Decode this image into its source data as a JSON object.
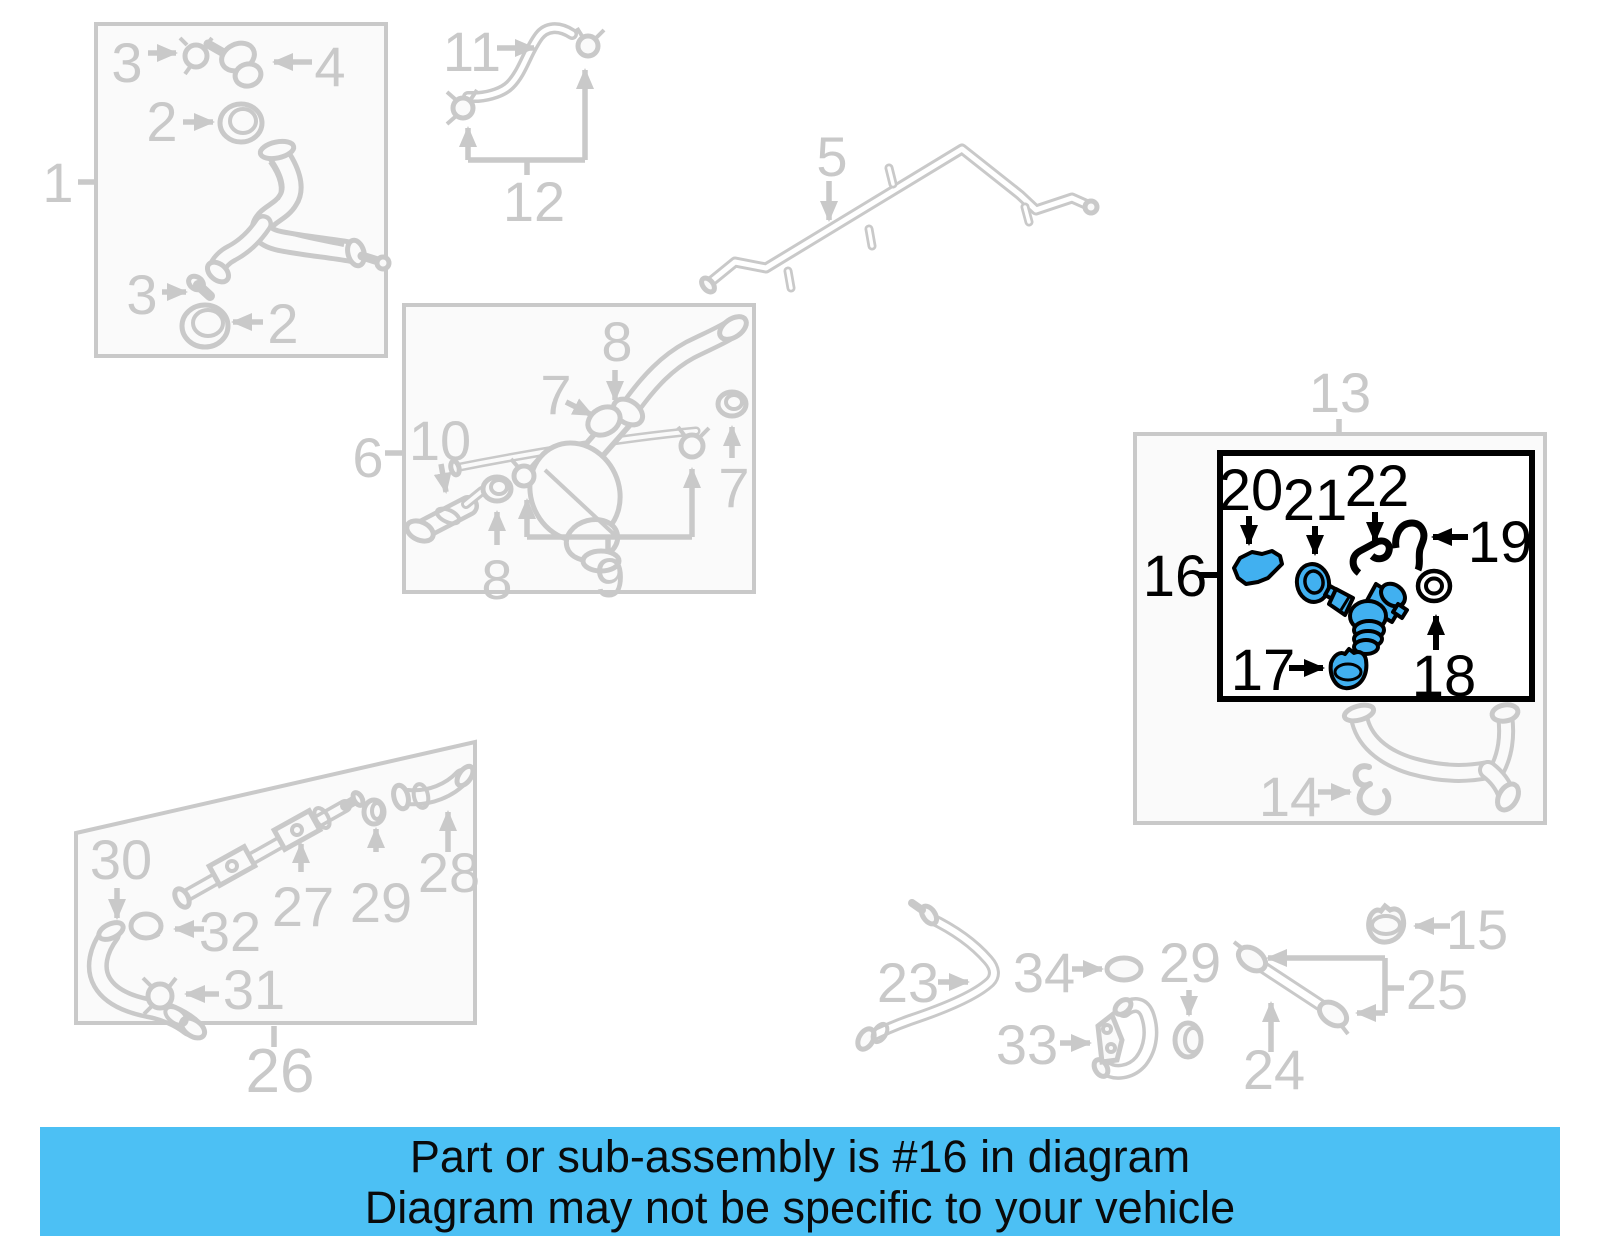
{
  "banner": {
    "line1": "Part or sub-assembly is #16 in diagram",
    "line2": "Diagram may not be specific to your vehicle"
  },
  "highlight": {
    "selected_callout": "16"
  },
  "colors": {
    "line_art": "#c9c9c9",
    "highlight_outline": "#000000",
    "highlight_fill": "#41b0f0",
    "banner_background": "#4cc0f4",
    "background": "#ffffff"
  },
  "callouts": {
    "box1": "1",
    "ring_top": "2",
    "clamp_top": "3",
    "fitting4": "4",
    "clamp_bottom": "3",
    "ring_bottom": "2",
    "pipe5": "5",
    "box6": "6",
    "fitting7": "7",
    "seal7": "7",
    "hose8": "8",
    "seal8": "8",
    "clamps9": "9",
    "connector10": "10",
    "hose11": "11",
    "clamps12": "12",
    "box13": "13",
    "clip14": "14",
    "cap15": "15",
    "assembly16": "16",
    "cap17": "17",
    "oring18": "18",
    "clip19": "19",
    "gasket20": "20",
    "seal21": "21",
    "clip22": "22",
    "pipe23": "23",
    "pipe24": "24",
    "clamps25": "25",
    "box26": "26",
    "pipe27": "27",
    "hose28": "28",
    "oring29": "29",
    "oring29b": "29",
    "elbow30": "30",
    "clamp31": "31",
    "cap32": "32",
    "bracket33": "33",
    "oring34": "34"
  }
}
